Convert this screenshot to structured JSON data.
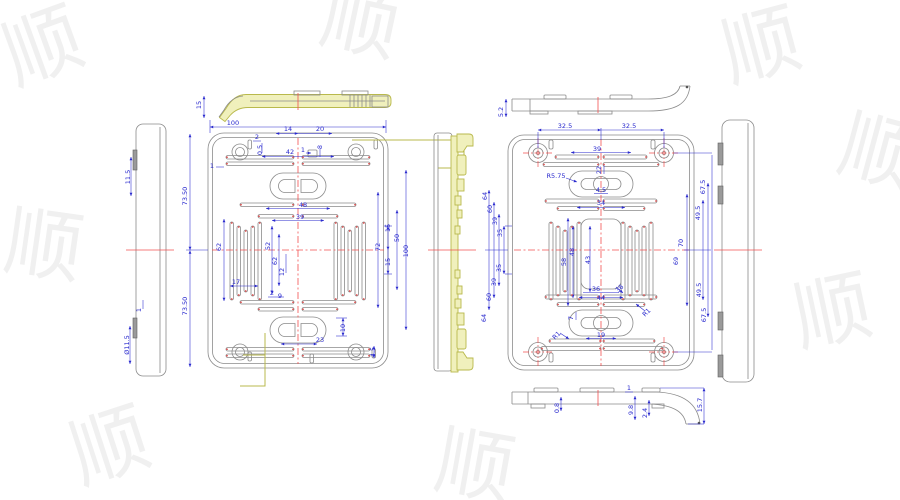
{
  "document_type": "CAD engineering drawing, multi-view part drawing of a rectangular cover plate",
  "colors": {
    "dimension_blue": "#2a2ace",
    "geometry_gray": "#8b8b8b",
    "centerline_red": "#f25050",
    "highlight_yellow": "#b9b94c",
    "point_marker_red": "#e05050",
    "watermark_gray": "#f0f0f0",
    "background": "#ffffff"
  },
  "watermark": {
    "glyph": "顺"
  },
  "views": [
    {
      "id": "top-left-profile",
      "name": "top profile view (left drawing, highlighted)"
    },
    {
      "id": "left-side",
      "name": "side view (left drawing)"
    },
    {
      "id": "left-main",
      "name": "front view of cover plate (left drawing)"
    },
    {
      "id": "mid-section",
      "name": "section side view with highlighted profile (center)"
    },
    {
      "id": "right-main",
      "name": "front view of cover plate (right drawing)"
    },
    {
      "id": "right-side",
      "name": "side view (right drawing)"
    },
    {
      "id": "top-right-profile",
      "name": "top profile view (right drawing)"
    },
    {
      "id": "bottom-right-profile",
      "name": "bottom profile view (right drawing)"
    }
  ],
  "annotations": [
    {
      "view": "left-side",
      "label": "11.5",
      "x": 130,
      "y": 177,
      "rot": -90
    },
    {
      "view": "left-side",
      "label": "1",
      "x": 141,
      "y": 310,
      "rot": -90
    },
    {
      "view": "left-side",
      "label": "Ø11.5",
      "x": 129,
      "y": 345,
      "rot": -90
    },
    {
      "view": "top-left-profile",
      "label": "15",
      "x": 201,
      "y": 105,
      "rot": -90
    },
    {
      "view": "left-main",
      "label": "100",
      "x": 233,
      "y": 125,
      "rot": 0
    },
    {
      "view": "left-main",
      "label": "14",
      "x": 288,
      "y": 131,
      "rot": 0
    },
    {
      "view": "left-main",
      "label": "20",
      "x": 320,
      "y": 131,
      "rot": 0
    },
    {
      "view": "left-main",
      "label": "2",
      "x": 257,
      "y": 139,
      "rot": 0
    },
    {
      "view": "left-main",
      "label": "0.5",
      "x": 262,
      "y": 150,
      "rot": -90
    },
    {
      "view": "left-main",
      "label": "42",
      "x": 290,
      "y": 154,
      "rot": 0
    },
    {
      "view": "left-main",
      "label": "1",
      "x": 303,
      "y": 152,
      "rot": 0
    },
    {
      "view": "left-main",
      "label": "8",
      "x": 322,
      "y": 147,
      "rot": -90
    },
    {
      "view": "left-main",
      "label": "1",
      "x": 212,
      "y": 168,
      "rot": 0
    },
    {
      "view": "left-main",
      "label": "73.50",
      "x": 187,
      "y": 196,
      "rot": -90
    },
    {
      "view": "left-main",
      "label": "73.50",
      "x": 187,
      "y": 306,
      "rot": -90
    },
    {
      "view": "left-main",
      "label": "48",
      "x": 303,
      "y": 207,
      "rot": 0
    },
    {
      "view": "left-main",
      "label": "39",
      "x": 300,
      "y": 219,
      "rot": 0
    },
    {
      "view": "left-main",
      "label": "62",
      "x": 221,
      "y": 247,
      "rot": -90
    },
    {
      "view": "left-main",
      "label": "52",
      "x": 270,
      "y": 246,
      "rot": -90
    },
    {
      "view": "left-main",
      "label": "62",
      "x": 277,
      "y": 261,
      "rot": -90
    },
    {
      "view": "left-main",
      "label": "12",
      "x": 284,
      "y": 272,
      "rot": -90
    },
    {
      "view": "left-main",
      "label": "17",
      "x": 236,
      "y": 284,
      "rot": 0
    },
    {
      "view": "left-main",
      "label": "72",
      "x": 380,
      "y": 247,
      "rot": -90
    },
    {
      "view": "left-main",
      "label": "15",
      "x": 390,
      "y": 228,
      "rot": -90
    },
    {
      "view": "left-main",
      "label": "15",
      "x": 390,
      "y": 262,
      "rot": -90
    },
    {
      "view": "left-main",
      "label": "50",
      "x": 399,
      "y": 238,
      "rot": -90
    },
    {
      "view": "left-main",
      "label": "100",
      "x": 408,
      "y": 251,
      "rot": -90
    },
    {
      "view": "left-main",
      "label": "2",
      "x": 272,
      "y": 295,
      "rot": 0
    },
    {
      "view": "left-main",
      "label": "9",
      "x": 280,
      "y": 298,
      "rot": 0
    },
    {
      "view": "left-main",
      "label": "10",
      "x": 345,
      "y": 328,
      "rot": -90
    },
    {
      "view": "left-main",
      "label": "23",
      "x": 320,
      "y": 342,
      "rot": 0
    },
    {
      "view": "left-main",
      "label": "4.5",
      "x": 375,
      "y": 352,
      "rot": -90
    },
    {
      "view": "top-right-profile",
      "label": "5.2",
      "x": 503,
      "y": 112,
      "rot": -90
    },
    {
      "view": "right-main",
      "label": "32.5",
      "x": 565,
      "y": 128,
      "rot": 0
    },
    {
      "view": "right-main",
      "label": "32.5",
      "x": 629,
      "y": 128,
      "rot": 0
    },
    {
      "view": "right-main",
      "label": "39",
      "x": 597,
      "y": 151,
      "rot": 0
    },
    {
      "view": "right-main",
      "label": "R5.75",
      "x": 556,
      "y": 178,
      "rot": 0
    },
    {
      "view": "right-main",
      "label": "22",
      "x": 601,
      "y": 170,
      "rot": -90
    },
    {
      "view": "right-main",
      "label": "4.5",
      "x": 601,
      "y": 192,
      "rot": 0
    },
    {
      "view": "right-main",
      "label": "34",
      "x": 601,
      "y": 205,
      "rot": 0
    },
    {
      "view": "right-main",
      "label": "64",
      "x": 487,
      "y": 196,
      "rot": -90
    },
    {
      "view": "right-main",
      "label": "60",
      "x": 492,
      "y": 209,
      "rot": -90
    },
    {
      "view": "right-main",
      "label": "39",
      "x": 497,
      "y": 221,
      "rot": -90
    },
    {
      "view": "right-main",
      "label": "35",
      "x": 502,
      "y": 233,
      "rot": -90
    },
    {
      "view": "right-main",
      "label": "35",
      "x": 501,
      "y": 268,
      "rot": -90
    },
    {
      "view": "right-main",
      "label": "39",
      "x": 496,
      "y": 282,
      "rot": -90
    },
    {
      "view": "right-main",
      "label": "60",
      "x": 491,
      "y": 297,
      "rot": -90
    },
    {
      "view": "right-main",
      "label": "64",
      "x": 486,
      "y": 318,
      "rot": -90
    },
    {
      "view": "right-main",
      "label": "58",
      "x": 566,
      "y": 262,
      "rot": -90
    },
    {
      "view": "right-main",
      "label": "48",
      "x": 574,
      "y": 252,
      "rot": -90
    },
    {
      "view": "right-main",
      "label": "43",
      "x": 590,
      "y": 260,
      "rot": -90
    },
    {
      "view": "right-main",
      "label": "36",
      "x": 596,
      "y": 291,
      "rot": 0
    },
    {
      "view": "right-main",
      "label": "44",
      "x": 601,
      "y": 300,
      "rot": 0
    },
    {
      "view": "right-main",
      "label": "38",
      "x": 621,
      "y": 290,
      "rot": -45
    },
    {
      "view": "right-main",
      "label": "R1",
      "x": 648,
      "y": 314,
      "rot": -45
    },
    {
      "view": "right-main",
      "label": "R1",
      "x": 558,
      "y": 337,
      "rot": -45
    },
    {
      "view": "right-main",
      "label": "7",
      "x": 573,
      "y": 318,
      "rot": -90
    },
    {
      "view": "right-main",
      "label": "19",
      "x": 601,
      "y": 337,
      "rot": 0
    },
    {
      "view": "right-main",
      "label": "70",
      "x": 683,
      "y": 243,
      "rot": -90
    },
    {
      "view": "right-main",
      "label": "69",
      "x": 678,
      "y": 261,
      "rot": -90
    },
    {
      "view": "right-main",
      "label": "67.5",
      "x": 705,
      "y": 187,
      "rot": -90
    },
    {
      "view": "right-main",
      "label": "49.5",
      "x": 700,
      "y": 213,
      "rot": -90
    },
    {
      "view": "right-main",
      "label": "49.5",
      "x": 701,
      "y": 290,
      "rot": -90
    },
    {
      "view": "right-main",
      "label": "67.5",
      "x": 706,
      "y": 315,
      "rot": -90
    },
    {
      "view": "bottom-right-profile",
      "label": "0.8",
      "x": 559,
      "y": 408,
      "rot": -90
    },
    {
      "view": "bottom-right-profile",
      "label": "1",
      "x": 629,
      "y": 390,
      "rot": 0
    },
    {
      "view": "bottom-right-profile",
      "label": "9.8",
      "x": 633,
      "y": 410,
      "rot": -90
    },
    {
      "view": "bottom-right-profile",
      "label": "2.4",
      "x": 647,
      "y": 413,
      "rot": -90
    },
    {
      "view": "bottom-right-profile",
      "label": "15.7",
      "x": 702,
      "y": 405,
      "rot": -90
    }
  ]
}
